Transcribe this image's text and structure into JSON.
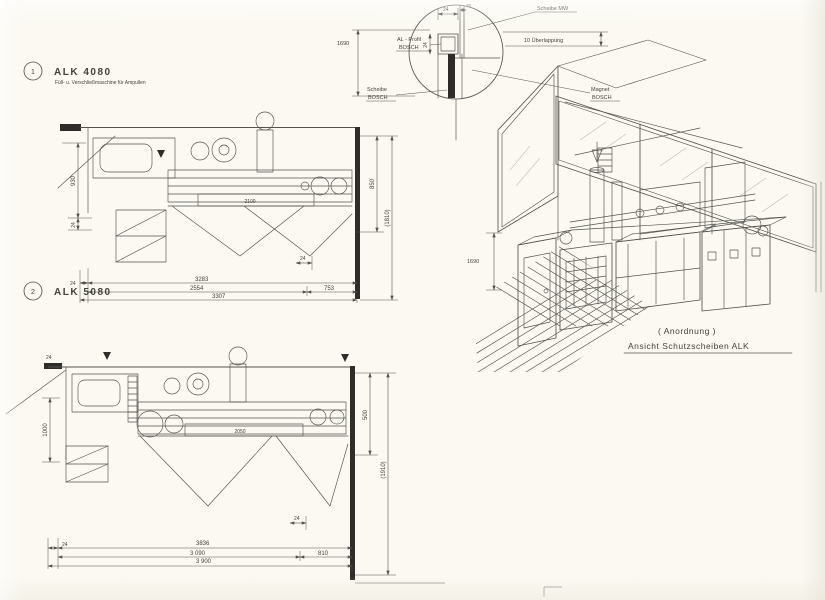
{
  "meta": {
    "colors": {
      "paper": "#fbf9f2",
      "ink": "#55534e",
      "ink-dark": "#2e2d2a",
      "text": "#44423c"
    }
  },
  "plan1": {
    "index": "1",
    "title": "ALK 4080",
    "subtitle": "Füll- u. Verschließmaschine für Ampullen",
    "dims": {
      "h930": "930",
      "d24": "24",
      "h850": "850",
      "h1810": "(1810)",
      "len3283": "3283",
      "len2554": "2554",
      "len753": "753",
      "total": "3307",
      "machine": "2100"
    }
  },
  "plan2": {
    "index": "2",
    "title": "ALK 5080",
    "dims": {
      "h1000": "1000",
      "d24": "24",
      "h500": "500",
      "h1910": "(1910)",
      "len3836": "3836",
      "len3090": "3 090",
      "len810": "810",
      "total": "3 900",
      "machine": "2050"
    }
  },
  "detail": {
    "dims": {
      "h1690": "1690",
      "d24": "24",
      "d10": "10"
    },
    "labels": {
      "profile_line1": "AL - Profil",
      "profile_line2": "BOSCH",
      "pane_top": "Scheibe MW",
      "overlap": "10 Überlappung",
      "pane_line1": "Scheibe",
      "pane_line2": "BOSCH",
      "magnet_line1": "Magnet",
      "magnet_line2": "BOSCH"
    }
  },
  "iso": {
    "dims": {
      "h1690": "1690"
    },
    "caption_line1": "( Anordnung )",
    "caption_line2": "Ansicht  Schutzscheiben  ALK"
  }
}
